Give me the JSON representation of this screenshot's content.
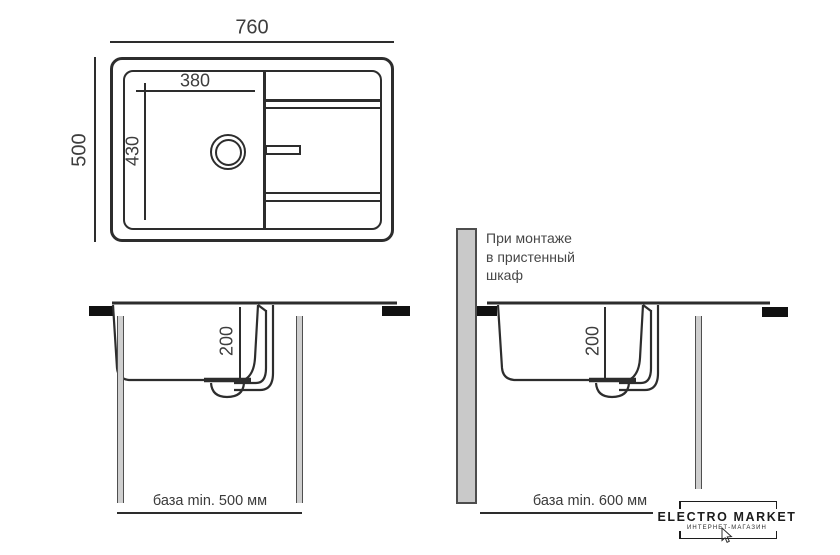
{
  "colors": {
    "background": "#ffffff",
    "line": "#2d2d2d",
    "text": "#3f3f3f",
    "clamp": "#111111",
    "panel_fill": "#cfcfcf",
    "panel_edge": "#4f4f4f",
    "wall_panel_fill": "#c9c9c9",
    "logo": "#1c1c1c"
  },
  "top_view": {
    "overall_width": "760",
    "overall_depth": "500",
    "bowl_width": "380",
    "bowl_depth": "430"
  },
  "section_left": {
    "depth": "200",
    "base_label": "база min. 500 мм"
  },
  "section_right": {
    "depth": "200",
    "base_label": "база min. 600 мм",
    "note": "При монтаже\nв пристенный\nшкаф"
  },
  "logo": {
    "title": "ELECTRO MARKET",
    "subtitle": "ИНТЕРНЕТ-МАГАЗИН"
  }
}
